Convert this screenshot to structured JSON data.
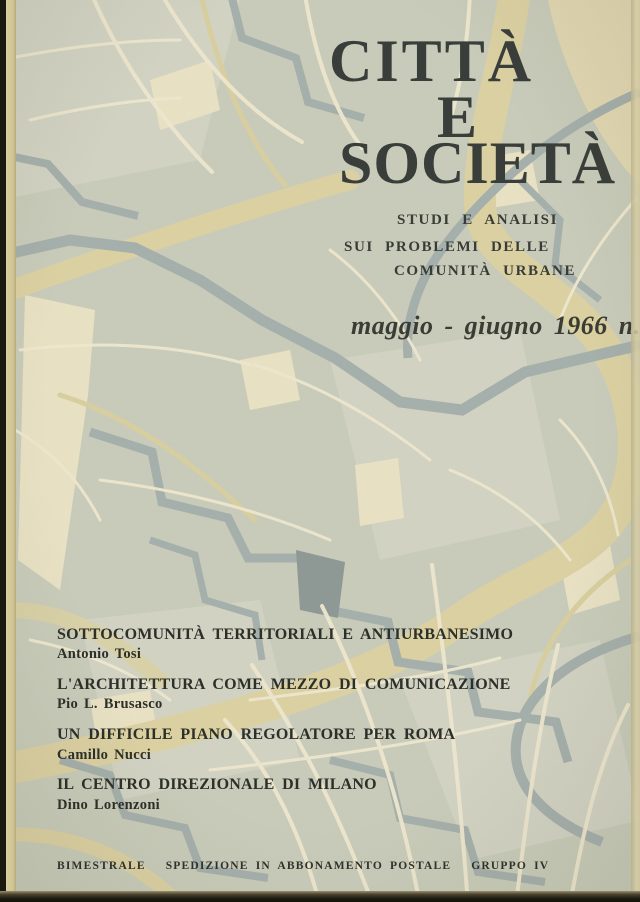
{
  "cover": {
    "title": {
      "line1": "CITTÀ",
      "line2": "E",
      "line3": "SOCIETÀ"
    },
    "subtitle": {
      "line1": "STUDI E ANALISI",
      "line2": "SUI PROBLEMI DELLE",
      "line3": "COMUNITÀ URBANE"
    },
    "issue_date": "maggio - giugno 1966  n. 3",
    "articles": [
      {
        "title": "SOTTOCOMUNITÀ TERRITORIALI E ANTIURBANESIMO",
        "author": "Antonio Tosi"
      },
      {
        "title": "L'ARCHITETTURA COME MEZZO DI COMUNICAZIONE",
        "author": "Pio L. Brusasco"
      },
      {
        "title": "UN DIFFICILE PIANO REGOLATORE PER ROMA",
        "author": "Camillo Nucci"
      },
      {
        "title": "IL CENTRO DIREZIONALE DI MILANO",
        "author": "Dino Lorenzoni"
      }
    ],
    "footer_items": [
      "BIMESTRALE",
      "SPEDIZIONE IN ABBONAMENTO POSTALE",
      "GRUPPO IV"
    ],
    "palette": {
      "map_base": "#c9ccba",
      "map_base_light": "#d4d6c5",
      "map_street_cream": "#efe8cf",
      "map_block_cream": "#ece5c8",
      "map_band_tan": "#dcd1a3",
      "map_canal_gray": "#a6b0ac",
      "map_canal_dark": "#8f9a96",
      "ink_title": "#3a3e3a",
      "ink_text": "#2d3029",
      "spine_dark": "#1b1a12",
      "page_edge": "#d8cf9f"
    },
    "background_description": "pictorial street-and-canal map artwork (Venice-style) covering the whole cover"
  }
}
